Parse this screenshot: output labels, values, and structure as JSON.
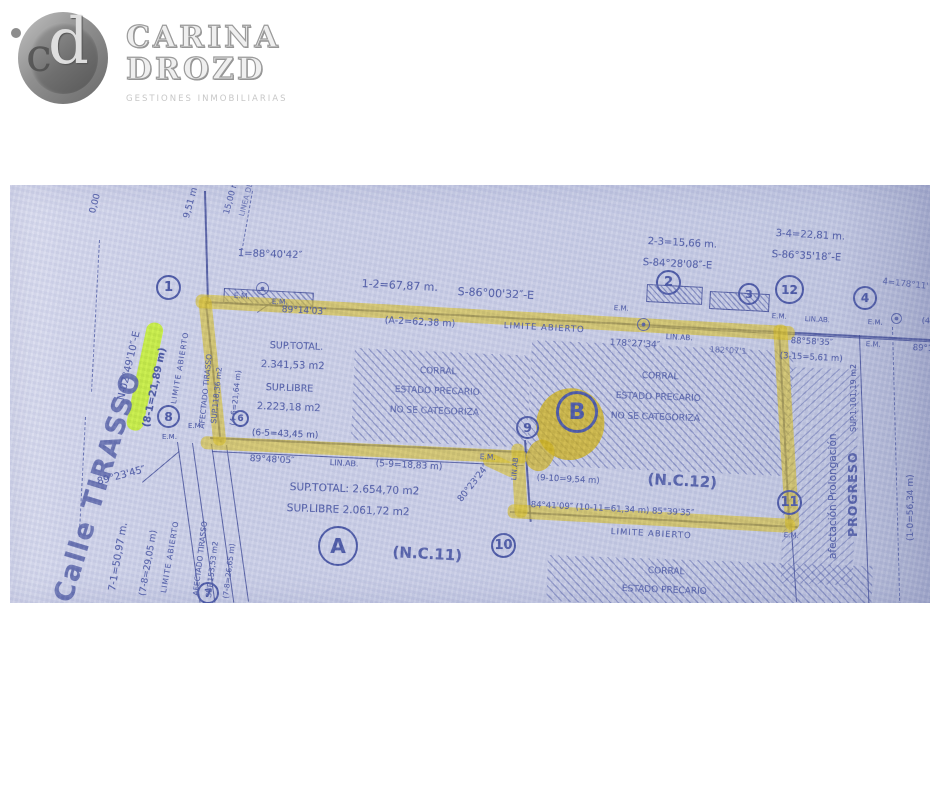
{
  "logo": {
    "name_line1": "CARINA",
    "name_line2": "DROZD",
    "tagline": "GESTIONES INMOBILIARIAS",
    "monogram_letters": {
      "c": "c",
      "d": "d"
    }
  },
  "plan": {
    "paper_color": "#cbcfe7",
    "ink_color": "#4956a4",
    "highlight_color": "rgba(216,190,34,0.62)",
    "highlight_strong_color": "rgba(206,176,18,0.78)",
    "green_highlight_color": "rgba(197,241,44,0.9)",
    "hatches": [
      {
        "x": 345,
        "y": 163,
        "w": 176,
        "h": 92,
        "r": 2.5
      },
      {
        "x": 522,
        "y": 155,
        "w": 262,
        "h": 125,
        "r": 2.5
      },
      {
        "x": 538,
        "y": 370,
        "w": 325,
        "h": 46,
        "r": 2
      },
      {
        "x": 778,
        "y": 182,
        "w": 72,
        "h": 216,
        "r": 2,
        "dir": 2
      }
    ],
    "walls": [
      {
        "x": 637,
        "y": 99,
        "w": 54,
        "h": 16,
        "r": 3
      },
      {
        "x": 700,
        "y": 106,
        "w": 58,
        "h": 16,
        "r": 3
      },
      {
        "x": 214,
        "y": 103,
        "w": 88,
        "h": 13,
        "r": 3
      }
    ],
    "lines": [
      {
        "x": 196,
        "y": 6,
        "len": 113,
        "r": 88.5,
        "w": 1.6
      },
      {
        "x": 196,
        "y": 116,
        "len": 730,
        "r": 3,
        "w": 1.7
      },
      {
        "x": 630,
        "y": 141,
        "len": 300,
        "r": 3,
        "w": 1.2
      },
      {
        "x": 197,
        "y": 118,
        "len": 140,
        "r": 84,
        "w": 1.6
      },
      {
        "x": 200,
        "y": 252,
        "len": 320,
        "r": 2.6,
        "w": 1.6
      },
      {
        "x": 202,
        "y": 266,
        "len": 312,
        "r": 2.6,
        "w": 1
      },
      {
        "x": 168,
        "y": 257,
        "len": 162,
        "r": 82,
        "w": 1.2
      },
      {
        "x": 183,
        "y": 258,
        "len": 161,
        "r": 82,
        "w": 1.2
      },
      {
        "x": 202,
        "y": 259,
        "len": 160,
        "r": 82,
        "w": 1.2
      },
      {
        "x": 217,
        "y": 260,
        "len": 158,
        "r": 82,
        "w": 1.2
      },
      {
        "x": 516,
        "y": 255,
        "len": 82,
        "r": 86,
        "w": 1.5
      },
      {
        "x": 500,
        "y": 326,
        "len": 288,
        "r": 3,
        "w": 1.5
      },
      {
        "x": 770,
        "y": 143,
        "len": 201,
        "r": 87,
        "w": 1.5
      },
      {
        "x": 781,
        "y": 331,
        "len": 86,
        "r": 86,
        "w": 1.2
      },
      {
        "x": 850,
        "y": 150,
        "len": 269,
        "r": 88,
        "w": 1.2
      },
      {
        "x": 883,
        "y": 142,
        "len": 279,
        "r": 88.5,
        "w": 1.4,
        "dash": true
      },
      {
        "x": 90,
        "y": 55,
        "len": 152,
        "r": 93,
        "w": 1.4,
        "dash": true
      },
      {
        "x": 76,
        "y": 232,
        "len": 120,
        "r": 93,
        "w": 1.3,
        "dash": true
      },
      {
        "x": 243,
        "y": 6,
        "len": 56,
        "r": 100,
        "w": 1.2,
        "dash": true
      },
      {
        "x": 132,
        "y": 297,
        "len": 48,
        "r": -40,
        "w": 1.1
      },
      {
        "x": 247,
        "y": 127,
        "len": 22,
        "r": -35,
        "w": 1.1
      }
    ],
    "highlights": [
      {
        "x": 186,
        "y": 109,
        "w": 600,
        "h": 14,
        "r": 3.1
      },
      {
        "x": 188,
        "y": 112,
        "w": 13,
        "h": 150,
        "r": -6
      },
      {
        "x": 191,
        "y": 251,
        "w": 327,
        "h": 13,
        "r": 2.6
      },
      {
        "x": 501,
        "y": 259,
        "w": 13,
        "h": 74,
        "r": -3
      },
      {
        "x": 477,
        "y": 266,
        "w": 36,
        "h": 14,
        "r": 25
      },
      {
        "x": 498,
        "y": 319,
        "w": 288,
        "h": 14,
        "r": 3
      },
      {
        "x": 763,
        "y": 140,
        "w": 14,
        "h": 206,
        "r": -3.5
      },
      {
        "x": 536,
        "y": 196,
        "w": 68,
        "h": 72,
        "r": 14,
        "rad": "50%",
        "c": "rgba(206,176,18,0.78)"
      },
      {
        "x": 527,
        "y": 250,
        "w": 26,
        "h": 32,
        "r": 30,
        "rad": "45%",
        "c": "rgba(206,176,18,0.7)"
      },
      {
        "x": 138,
        "y": 136,
        "w": 17,
        "h": 110,
        "r": 12,
        "rad": "8px",
        "c": "rgba(197,241,44,0.9)"
      }
    ],
    "markers": [
      {
        "x": 246,
        "y": 97,
        "d": 13
      },
      {
        "x": 627,
        "y": 133,
        "d": 13
      },
      {
        "x": 881,
        "y": 128,
        "d": 11
      }
    ],
    "badges": [
      {
        "t": "1",
        "x": 146,
        "y": 90,
        "d": 25
      },
      {
        "t": "2",
        "x": 646,
        "y": 85,
        "d": 25
      },
      {
        "t": "3",
        "x": 728,
        "y": 98,
        "d": 22
      },
      {
        "t": "12",
        "x": 765,
        "y": 90,
        "d": 29,
        "fs": 12
      },
      {
        "t": "4",
        "x": 843,
        "y": 101,
        "d": 24
      },
      {
        "t": "8",
        "x": 147,
        "y": 220,
        "d": 23
      },
      {
        "t": "6",
        "x": 222,
        "y": 225,
        "d": 17,
        "fs": 9
      },
      {
        "t": "9",
        "x": 506,
        "y": 231,
        "d": 23
      },
      {
        "t": "10",
        "x": 481,
        "y": 348,
        "d": 25
      },
      {
        "t": "11",
        "x": 767,
        "y": 305,
        "d": 25
      },
      {
        "t": "7",
        "x": 187,
        "y": 397,
        "d": 22
      },
      {
        "t": "A",
        "x": 308,
        "y": 341,
        "d": 40,
        "fs": 20,
        "b": 2.5,
        "n": "parcel-a-badge"
      },
      {
        "t": "B",
        "x": 546,
        "y": 206,
        "d": 42,
        "fs": 22,
        "b": 3,
        "n": "parcel-b-badge"
      }
    ],
    "labels": [
      {
        "t": "0,00",
        "x": 78,
        "y": 27,
        "r": -75,
        "s": 9
      },
      {
        "t": "9,51 m",
        "x": 172,
        "y": 32,
        "r": -75,
        "s": 9
      },
      {
        "t": "15,00 m",
        "x": 212,
        "y": 28,
        "r": -75,
        "s": 8.5
      },
      {
        "t": "LINEA DE",
        "x": 227,
        "y": 30,
        "r": -75,
        "s": 7.5,
        "o": 0.7
      },
      {
        "t": "1̂=88°40'42″",
        "x": 228,
        "y": 63,
        "r": 2,
        "s": 10
      },
      {
        "t": "E.M.",
        "x": 224,
        "y": 106,
        "r": 2,
        "s": 7.5
      },
      {
        "t": "E.M.",
        "x": 262,
        "y": 112,
        "r": 2,
        "s": 7.5
      },
      {
        "t": "1-2=67,87 m.",
        "x": 352,
        "y": 92,
        "r": 3,
        "s": 11
      },
      {
        "t": "S-86°00'32″-E",
        "x": 448,
        "y": 100,
        "r": 3,
        "s": 11
      },
      {
        "t": "(A-2=62,38 m)",
        "x": 375,
        "y": 130,
        "r": 3,
        "s": 9.5
      },
      {
        "t": "LIMITE ABIERTO",
        "x": 494,
        "y": 136,
        "r": 3,
        "s": 8.5,
        "ls": 1
      },
      {
        "t": "178°27'34″",
        "x": 600,
        "y": 153,
        "r": 3,
        "s": 9
      },
      {
        "t": "182°07'1",
        "x": 700,
        "y": 160,
        "r": 3,
        "s": 8,
        "o": 0.75
      },
      {
        "t": "E.M.",
        "x": 604,
        "y": 119,
        "r": 3,
        "s": 7
      },
      {
        "t": "LIN.AB.",
        "x": 656,
        "y": 147,
        "r": 3,
        "s": 7.5
      },
      {
        "t": "2-3=15,66 m.",
        "x": 638,
        "y": 51,
        "r": 3,
        "s": 10
      },
      {
        "t": "S-84°28'08″-E",
        "x": 633,
        "y": 72,
        "r": 3,
        "s": 10
      },
      {
        "t": "3-4=22,81 m.",
        "x": 766,
        "y": 43,
        "r": 3,
        "s": 10
      },
      {
        "t": "S-86°35'18″-E",
        "x": 762,
        "y": 64,
        "r": 3,
        "s": 10
      },
      {
        "t": "4̂=178°11'",
        "x": 873,
        "y": 92,
        "r": 6,
        "s": 8.5,
        "o": 0.8
      },
      {
        "t": "E.M.",
        "x": 762,
        "y": 127,
        "r": 3,
        "s": 7
      },
      {
        "t": "LIN.AB.",
        "x": 795,
        "y": 130,
        "r": 3,
        "s": 7
      },
      {
        "t": "E.M.",
        "x": 858,
        "y": 133,
        "r": 3,
        "s": 7
      },
      {
        "t": "(4-",
        "x": 912,
        "y": 131,
        "r": 3,
        "s": 8
      },
      {
        "t": "88°58'35″",
        "x": 781,
        "y": 151,
        "r": 3,
        "s": 8.5
      },
      {
        "t": "(3-15=5,61 m)",
        "x": 770,
        "y": 166,
        "r": 3,
        "s": 8.5
      },
      {
        "t": "E.M.",
        "x": 856,
        "y": 155,
        "r": 3,
        "s": 7
      },
      {
        "t": "89°1",
        "x": 903,
        "y": 158,
        "r": 3,
        "s": 8.5
      },
      {
        "t": "Calle TIRASSO",
        "x": 38,
        "y": 412,
        "r": -73,
        "s": 27,
        "w": 600,
        "c": "#5d68ac",
        "ls": 2,
        "n": "street-name-label"
      },
      {
        "t": "N-02°49'10″-E",
        "x": 106,
        "y": 214,
        "r": -77,
        "s": 10
      },
      {
        "t": "(8-1=21,89 m)",
        "x": 131,
        "y": 241,
        "r": -78,
        "s": 10,
        "w": 600,
        "c": "#3e4c9d",
        "n": "highlighted-measure-label"
      },
      {
        "t": "LIMITE ABIERTO",
        "x": 159,
        "y": 218,
        "r": -80,
        "s": 7.5,
        "ls": 1
      },
      {
        "t": "AFECTADO TIRASSO",
        "x": 187,
        "y": 243,
        "r": -84,
        "s": 7.5
      },
      {
        "t": "SUP.118,36 m2",
        "x": 199,
        "y": 238,
        "r": -84,
        "s": 7.5
      },
      {
        "t": "(4-6=21,64 m)",
        "x": 218,
        "y": 240,
        "r": -84,
        "s": 7.5
      },
      {
        "t": "E.M.",
        "x": 152,
        "y": 248,
        "r": 0,
        "s": 7
      },
      {
        "t": "E.M.",
        "x": 178,
        "y": 237,
        "r": 0,
        "s": 7
      },
      {
        "t": "89°23'45″",
        "x": 86,
        "y": 292,
        "r": -15,
        "s": 10
      },
      {
        "t": "7-1=50,97 m.",
        "x": 97,
        "y": 405,
        "r": -80,
        "s": 10
      },
      {
        "t": "(7-8=29,05 m)",
        "x": 128,
        "y": 410,
        "r": -80,
        "s": 9
      },
      {
        "t": "LIMITE ABIERTO",
        "x": 149,
        "y": 407,
        "r": -80,
        "s": 7.5,
        "ls": 1
      },
      {
        "t": "AFECTADO TIRASSO",
        "x": 181,
        "y": 410,
        "r": -83,
        "s": 7.5
      },
      {
        "t": "SUP.153,53 m2",
        "x": 194,
        "y": 412,
        "r": -83,
        "s": 7.5
      },
      {
        "t": "(7-8=26,65 m)",
        "x": 211,
        "y": 413,
        "r": -83,
        "s": 7.5
      },
      {
        "t": "89°14'03″",
        "x": 272,
        "y": 120,
        "r": 3,
        "s": 9
      },
      {
        "t": "SUP.TOTAL.",
        "x": 260,
        "y": 155,
        "r": 2,
        "s": 9.5
      },
      {
        "t": "2.341,53 m2",
        "x": 251,
        "y": 174,
        "r": 2,
        "s": 10,
        "n": "parcel-b-sup-total-value"
      },
      {
        "t": "SUP.LIBRE",
        "x": 256,
        "y": 197,
        "r": 2,
        "s": 9.5
      },
      {
        "t": "2.223,18 m2",
        "x": 247,
        "y": 216,
        "r": 2,
        "s": 10,
        "n": "parcel-b-sup-libre-value"
      },
      {
        "t": "(6-5=43,45 m)",
        "x": 242,
        "y": 243,
        "r": 2.5,
        "s": 9,
        "c": "#3e4c9d"
      },
      {
        "t": "89°48'05″",
        "x": 240,
        "y": 269,
        "r": 3,
        "s": 9
      },
      {
        "t": "LIN.AB.",
        "x": 320,
        "y": 273,
        "r": 3,
        "s": 8
      },
      {
        "t": "(5-9=18,83 m)",
        "x": 366,
        "y": 274,
        "r": 3,
        "s": 9
      },
      {
        "t": "E.M.",
        "x": 470,
        "y": 267,
        "r": 3,
        "s": 7.5
      },
      {
        "t": "SUP.TOTAL:  2.654,70 m2",
        "x": 280,
        "y": 296,
        "r": 2,
        "s": 10.5,
        "n": "parcel-a-sup-total-value"
      },
      {
        "t": "SUP.LIBRE  2.061,72 m2",
        "x": 277,
        "y": 317,
        "r": 2,
        "s": 10.5,
        "n": "parcel-a-sup-libre-value"
      },
      {
        "t": "80°23'24″",
        "x": 446,
        "y": 313,
        "r": -52,
        "s": 9
      },
      {
        "t": "LIN.AB",
        "x": 500,
        "y": 295,
        "r": -85,
        "s": 7
      },
      {
        "t": "(9-10=9,54 m)",
        "x": 527,
        "y": 288,
        "r": 3,
        "s": 8.5
      },
      {
        "t": "(N.C.12)",
        "x": 638,
        "y": 285,
        "r": 3,
        "s": 15,
        "w": 600,
        "n": "parcel-b-nc-label"
      },
      {
        "t": "84°41'09″ (10-11=61,34 m) 85°39'35″",
        "x": 521,
        "y": 315,
        "r": 3,
        "s": 8.5
      },
      {
        "t": "LIMITE ABIERTO",
        "x": 601,
        "y": 342,
        "r": 3,
        "s": 8.5,
        "ls": 1
      },
      {
        "t": "E.M.",
        "x": 774,
        "y": 346,
        "r": 3,
        "s": 7
      },
      {
        "t": "CORRAL",
        "x": 410,
        "y": 181,
        "r": 2,
        "s": 9,
        "o": 0.8
      },
      {
        "t": "ESTADO PRECARIO",
        "x": 385,
        "y": 200,
        "r": 2,
        "s": 9,
        "o": 0.8
      },
      {
        "t": "NO SE CATEGORIZA",
        "x": 380,
        "y": 220,
        "r": 2,
        "s": 9,
        "o": 0.8
      },
      {
        "t": "CORRAL",
        "x": 632,
        "y": 186,
        "r": 2,
        "s": 9,
        "o": 0.85
      },
      {
        "t": "ESTADO PRECARIO",
        "x": 606,
        "y": 206,
        "r": 2,
        "s": 9,
        "o": 0.85
      },
      {
        "t": "NO SE CATEGORIZA",
        "x": 601,
        "y": 226,
        "r": 2,
        "s": 9,
        "o": 0.85
      },
      {
        "t": "CORRAL",
        "x": 638,
        "y": 381,
        "r": 2,
        "s": 9,
        "o": 0.85
      },
      {
        "t": "ESTADO PRECARIO",
        "x": 612,
        "y": 399,
        "r": 2,
        "s": 9,
        "o": 0.85
      },
      {
        "t": "(N.C.11)",
        "x": 383,
        "y": 358,
        "r": 3,
        "s": 15,
        "w": 600,
        "n": "parcel-a-nc-label"
      },
      {
        "t": "afectación  Prolongación",
        "x": 817,
        "y": 374,
        "r": -90,
        "s": 10.5,
        "n": "affectation-label"
      },
      {
        "t": "PROGRESO",
        "x": 835,
        "y": 352,
        "r": -90,
        "s": 12.5,
        "w": 700,
        "ls": 1,
        "n": "progreso-street-label"
      },
      {
        "t": "SUP.1.101,19 m2",
        "x": 839,
        "y": 247,
        "r": -90,
        "s": 8
      },
      {
        "t": "(1-0=56,34 m)",
        "x": 896,
        "y": 356,
        "r": -90,
        "s": 9
      }
    ]
  }
}
